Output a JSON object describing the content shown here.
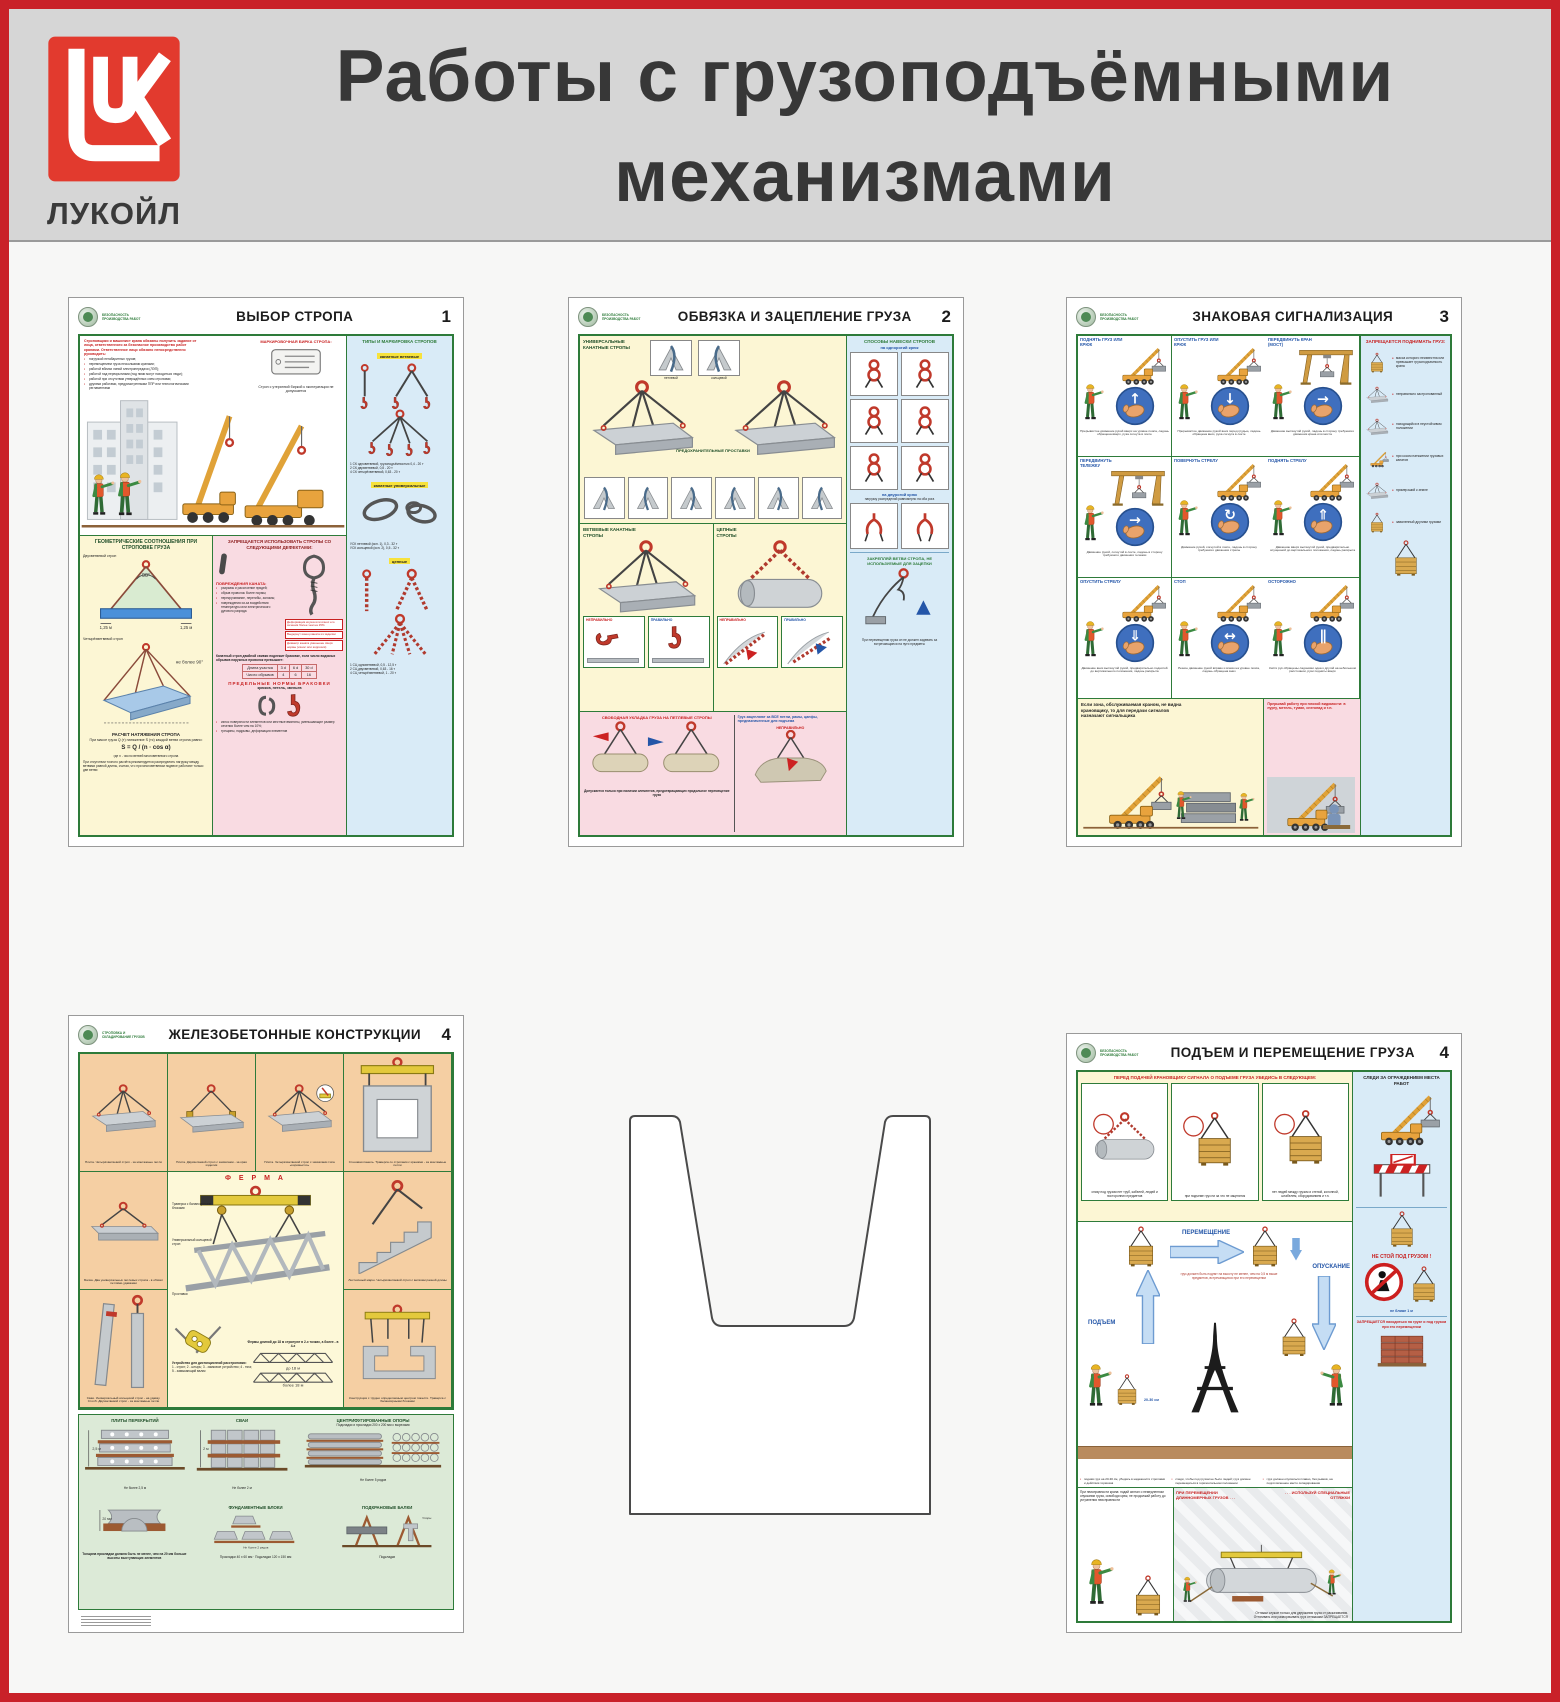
{
  "frame": {
    "title_line1": "Работы с грузоподъёмными",
    "title_line2": "механизмами",
    "brand": "ЛУКОЙЛ"
  },
  "badge_safety": "Безопасность производства работ",
  "badge_stropovka": "Строповка и складирование грузов",
  "p1": {
    "title": "ВЫБОР СТРОПА",
    "num": "1",
    "intro": "Строповщики и машинист крана обязаны получить задание от лица, ответственного за безопасное производство работ кранами. Ответственное лицо обязано непосредственно руководить:",
    "intro_items": [
      "погрузкой негабаритных грузов;",
      "перемещением груза несколькими кранами;",
      "работой вблизи линий электропередачи (ЛЭП);",
      "работой над перекрытиями (под ними могут находиться люди);",
      "работой при отсутствии утверждённых схем строповки;",
      "другими работами, предусмотренными ППР или технологическими регламентами"
    ],
    "tag_title": "МАРКИРОВОЧНАЯ БИРКА СТРОПА:",
    "tag_note": "Строп с утерянной биркой к эксплуатации не допускается",
    "geom_title": "ГЕОМЕТРИЧЕСКИЕ СООТНОШЕНИЯ ПРИ СТРОПОВКЕ ГРУЗА",
    "geom_cap1": "Двухветвевой строп",
    "geom_cap2": "Четырёхветвевой строп",
    "geom_cap3": "не более 90°",
    "geom_dim": "1,25 м",
    "geom_angle": "90°",
    "calc_title": "РАСЧЕТ НАТЯЖЕНИЯ СТРОПА",
    "calc_note": "При массе груза Q (т) натяжение S (тс) каждой ветви стропа равно:",
    "calc_formula": "S = Q / (n · cos α)",
    "calc_where": "где n - число ветвей многоветвевого стропа",
    "calc_foot": "При отсутствии точного расчёта рекомендуется распределять нагрузку между ветвями равной длины, считая, что при многоветвевом подвесе работают только две ветви",
    "defects_title": "ЗАПРЕЩАЕТСЯ ИСПОЛЬЗОВАТЬ СТРОПЫ СО СЛЕДУЮЩИМИ ДЕФЕКТАМИ:",
    "damage_title": "ПОВРЕЖДЕНИЯ КАНАТА:",
    "damage_items": [
      "разрывы и расслоение прядей;",
      "обрыв проволок более нормы;",
      "перекручивание, перегибы, заломы;",
      "повреждения из-за воздействия температуры или электрического дугового разряда"
    ],
    "callouts": [
      "Деформация коуша или износ его сечения более чем на 15%",
      "Выдернут конец каната из заделки",
      "Диаметр каната уменьшен сверх нормы (износ или коррозия)"
    ],
    "wear_note": "Канатный строп двойной свивки подлежит браковке, если число видимых обрывов наружных проволок превышает:",
    "table_h": [
      "Длина участка",
      "3 d",
      "6 d",
      "30 d"
    ],
    "table_r": [
      "Число обрывов",
      "4",
      "6",
      "16"
    ],
    "norms_title": "ПРЕДЕЛЬНЫЕ НОРМЫ БРАКОВКИ",
    "norms_sub": "крюков, петель, звеньев",
    "norm_items": [
      "износ поверхности элементов или местные вмятины, уменьшающие размер сечения более чем на 10%;",
      "трещины, надрывы, деформация элементов"
    ],
    "types_title": "ТИПЫ И МАРКИРОВКА СТРОПОВ",
    "t1": "канатные ветвевые",
    "t1_items": [
      "1 СК одноветвевой, грузоподъёмностью 0,4 - 20 т",
      "2 СК двухветвевой, 0,8 - 20 т",
      "4 СК четырёхветвевой, 0,63 - 20 т"
    ],
    "t2": "канатные универсальные",
    "t2_items": [
      "УСК петлевой (исп. 1), 0,3 - 32 т",
      "УСК кольцевой (исп. 2), 0,5 - 32 т"
    ],
    "t3": "цепные",
    "t3_items": [
      "1 СЦ одноветвевой, 0,5 - 12,5 т",
      "2 СЦ двухветвевой, 0,63 - 16 т",
      "4 СЦ четырёхветвевой, 1 - 20 т"
    ]
  },
  "p2": {
    "title": "ОБВЯЗКА И ЗАЦЕПЛЕНИЕ ГРУЗА",
    "num": "2",
    "sec1": "УНИВЕРСАЛЬНЫЕ КАНАТНЫЕ СТРОПЫ",
    "knot1": "петлевой",
    "knot2": "кольцевой",
    "spacers": "ПРЕДОХРАНИТЕЛЬНЫЕ ПРОСТАВКИ",
    "sec2": "ВЕТВЕВЫЕ КАНАТНЫЕ СТРОПЫ",
    "sec3": "ЦЕПНЫЕ СТРОПЫ",
    "wrong": "НЕПРАВИЛЬНО",
    "right": "ПРАВИЛЬНО",
    "pink_title": "СВОБОДНАЯ УКЛАДКА ГРУЗА НА ПЕТЛЕВЫЕ СТРОПЫ",
    "pink_note": "Допускается только при наличии элементов, предотвращающих продольное перемещение груза",
    "pink_right": "Груз зацепляют за ВСЕ петли, рамы, цапфы, предназначенные для подъема",
    "ways_title": "СПОСОБЫ НАВЕСКИ СТРОПОВ",
    "ways_sub1": "на однорогий крюк",
    "ways_sub2": "на двурогий крюк",
    "ways_note": "нагрузку распределяй равномерно на оба рога",
    "fix_note": "ЗАКРЕПЛЯЙ ВЕТВИ СТРОПА, НЕ ИСПОЛЬЗУЕМЫЕ ДЛЯ ЗАЦЕПКИ",
    "foot": "При перемещении груза он не должен задевать за встречающиеся на пути предметы"
  },
  "p3": {
    "title": "ЗНАКОВАЯ СИГНАЛИЗАЦИЯ",
    "num": "3",
    "cells": [
      {
        "label": "ПОДНЯТЬ ГРУЗ ИЛИ КРЮК",
        "cap": "Прерывистое движение рукой вверх на уровне пояса, ладонь обращена вверх, рука согнута в локте",
        "crane": "#s-crane",
        "glyph": "↑"
      },
      {
        "label": "ОПУСТИТЬ ГРУЗ ИЛИ КРЮК",
        "cap": "Прерывистое движение рукой вниз перед грудью, ладонь обращена вниз, рука согнута в локте",
        "crane": "#s-crane",
        "glyph": "↓"
      },
      {
        "label": "ПЕРЕДВИНУТЬ КРАН (МОСТ)",
        "cap": "Движение вытянутой рукой, ладонь в сторону требуемого движения крана или моста",
        "crane": "#s-gantry",
        "glyph": "→"
      },
      {
        "label": "ПЕРЕДВИНУТЬ ТЕЛЕЖКУ",
        "cap": "Движение рукой, согнутой в локте, ладонь в сторону требуемого движения тележки",
        "crane": "#s-gantry",
        "glyph": "→"
      },
      {
        "label": "ПОВЕРНУТЬ СТРЕЛУ",
        "cap": "Движение рукой, согнутой в локте, ладонь в сторону требуемого движения стрелы",
        "crane": "#s-crane",
        "glyph": "↻"
      },
      {
        "label": "ПОДНЯТЬ СТРЕЛУ",
        "cap": "Движение вверх вытянутой рукой, предварительно опущенной до вертикального положения, ладонь раскрыта",
        "crane": "#s-crane",
        "glyph": "⇑"
      },
      {
        "label": "ОПУСТИТЬ СТРЕЛУ",
        "cap": "Движение вниз вытянутой рукой, предварительно поднятой до вертикального положения, ладонь раскрыта",
        "crane": "#s-crane",
        "glyph": "⇓"
      },
      {
        "label": "СТОП",
        "cap": "Резкое движение рукой вправо и влево на уровне пояса, ладонь обращена вниз",
        "crane": "#s-crane",
        "glyph": "↔"
      },
      {
        "label": "ОСТОРОЖНО",
        "cap": "Кисти рук обращены ладонями одна к другой на небольшом расстоянии, руки подняты вверх",
        "crane": "#s-crane",
        "glyph": "∥"
      }
    ],
    "yellow_note": "Если зона, обслуживаемая краном, не видна крановщику, то для передачи сигналов назначают сигнальщика",
    "pink_note": "Прерывай работу при плохой видимости: в пургу, метель, туман, снегопад и т.п.",
    "right_title": "ЗАПРЕЩАЕТСЯ ПОДНИМАТЬ ГРУЗ:",
    "right_items": [
      {
        "t": "масса которого неизвестна или превышает грузоподъемность крана",
        "icon": "#s-crate"
      },
      {
        "t": "неправильно застропованный",
        "icon": "#s-slab4"
      },
      {
        "t": "находящийся в неустойчивом положении",
        "icon": "#s-slab4"
      },
      {
        "t": "при косом натяжении грузовых канатов",
        "icon": "#s-crane"
      },
      {
        "t": "примерзший к земле",
        "icon": "#s-slab4"
      },
      {
        "t": "заваленный другими грузами",
        "icon": "#s-crate"
      }
    ]
  },
  "p4": {
    "title": "ЖЕЛЕЗОБЕТОННЫЕ КОНСТРУКЦИИ",
    "num": "4",
    "c1": "Плита. Четырёхветвевой строп - за монтажные петли",
    "c2": "Плита. Двухветвевой строп с захватами - за края изделия",
    "c3": "Плита. Четырёхветвевой строп с захватами типа «коромысло»",
    "c4": "Стеновая панель. Траверса со стропами с крюками - за монтажные петли",
    "c5": "Балка. Два универсальных петлевых стропа - в обхват петлями-удавками",
    "c6": "Лестничный марш. Четырёхветвевой строп с ветвями разной длины",
    "c7": "Свая. Универсальный кольцевой строп - на удавку. Столб. Двухветвевой строп - за монтажные петли",
    "c8": "Конструкция с трудно определяемым центром тяжести. Траверса с балансирными блоками",
    "ferma": "Ф Е Р М А",
    "ferma_n1": "Траверса с балансирными блоками",
    "ferma_n2": "Универсальный кольцевой строп",
    "ferma_n3": "Проставки",
    "ferma_n4": "Устройство для дистанционной расстроповки:",
    "ferma_list": "1 - строп;  2 - штырь;  3 - замковое устройство;  4 - тяга;  5 - замыкающий валик",
    "ferma_note": "Фермы длиной до 18 м стропуют в 2-х точках, а более - в 4-х",
    "dim1": "до 18 м",
    "dim2": "более 18 м",
    "s1": "ПЛИТЫ ПЕРЕКРЫТИЙ",
    "s2": "СВАИ",
    "s3": "ЦЕНТРИФУГИРОВАННЫЕ ОПОРЫ",
    "s3_sub": "Подкладки и прокладки 200 х 200 мм с вырезами",
    "s4": "ФУНДАМЕНТНЫЕ БЛОКИ",
    "s5": "ПОДКРАНОВЫЕ БАЛКИ",
    "n1": "Не более 2,5 м",
    "n2": "Не более 2 м",
    "n3": "Не более 5 рядов",
    "n4": "Не более 2 рядов",
    "m1": "Прокладки 40 х 60 мм",
    "m2": "Подкладки 120 х 150 мм",
    "m3": "Не менее 20 мм",
    "m4": "Упоры",
    "m5": "Подкладки",
    "thick": "Толщина прокладки должна быть не менее, чем на 20 мм больше высоты выступающих элементов"
  },
  "p5": {
    "title": "ПОДЪЕМ И ПЕРЕМЕЩЕНИЕ ГРУЗА",
    "num": "4",
    "check_title": "ПЕРЕД ПОДАЧЕЙ КРАНОВЩИКУ СИГНАЛА О ПОДЪЕМЕ ГРУЗА УБЕДИСЬ В СЛЕДУЮЩЕМ:",
    "check_cells": [
      {
        "cap": "снизу под грузом нет труб, кабелей, людей и посторонних предметов",
        "icon": "#s-pipe-chain"
      },
      {
        "cap": "при подъеме груз ни за что не зацепится",
        "icon": "#s-crate"
      },
      {
        "cap": "нет людей между грузом и стеной, колонной, штабелем, оборудованием и т.п.",
        "icon": "#s-crate"
      }
    ],
    "m_lift": "ПОДЪЕМ",
    "m_move": "ПЕРЕМЕЩЕНИЕ",
    "m_down": "ОПУСКАНИЕ",
    "m_note": "груз должен быть поднят на высоту не менее, чем на 0,5 м выше предметов, встречающихся при его перемещении",
    "h_note": "20-30 см",
    "g_note1": "подняв груз на 20-30 см, убедись в надежности строповки и действия тормозов",
    "g_note2": "следи, чтобы под грузом не было людей; груз должен перемещаться в горизонтальном положении",
    "g_note3": "груз должен опускаться плавно, без рывков, на подготовленное место складирования",
    "fault_note": "При неисправности крана: подай сигнал о немедленном опускании груза, освободи крюк, не продолжай работу до устранения неисправности",
    "long1": "ПРИ ПЕРЕМЕЩЕНИИ ДЛИННОМЕРНЫХ ГРУЗОВ . . .",
    "long2": ". . . ИСПОЛЬЗУЙ СПЕЦИАЛЬНЫЕ ОТТЯЖКИ",
    "long_note": "Оттяжки служат только для удержания груза от раскачивания. Оттягивать или разворачивать груз оттяжками ЗАПРЕЩАЕТСЯ",
    "watch_title": "СЛЕДИ ЗА ОГРАЖДЕНИЕМ МЕСТА РАБОТ",
    "nostand": "НЕ СТОЙ ПОД ГРУЗОМ !",
    "near": "не ближе 1 м",
    "forbid": "ЗАПРЕЩАЕТСЯ находиться на грузе и под грузом при его перемещении"
  }
}
